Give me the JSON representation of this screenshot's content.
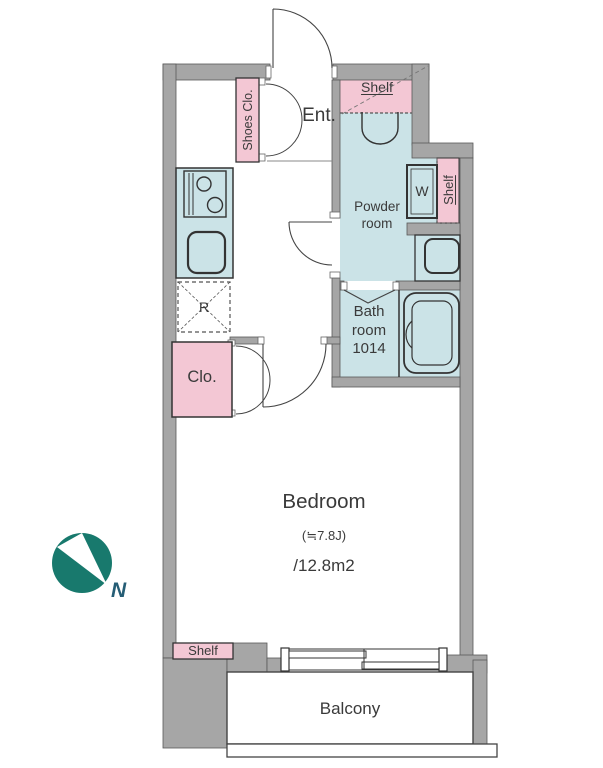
{
  "plan": {
    "entrance": {
      "label": "Ent."
    },
    "shoes_closet": {
      "label": "Shoes Clo."
    },
    "shelf_top": {
      "label": "Shelf"
    },
    "shelf_side": {
      "label": "Shelf"
    },
    "shelf_bottom": {
      "label": "Shelf"
    },
    "powder_room": {
      "label_line1": "Powder",
      "label_line2": "room"
    },
    "washer": {
      "label": "W"
    },
    "bathroom": {
      "label_line1": "Bath",
      "label_line2": "room",
      "label_line3": "1014"
    },
    "refrigerator": {
      "label": "R"
    },
    "closet": {
      "label": "Clo."
    },
    "bedroom": {
      "label": "Bedroom",
      "size_jo": "(≒7.8J)",
      "size_m2": "/12.8m2"
    },
    "balcony": {
      "label": "Balcony"
    },
    "compass": {
      "label": "N"
    }
  },
  "colors": {
    "wall_gray": "#a6a6a6",
    "wet_area_blue": "#cbe3e7",
    "storage_pink": "#f3c7d4",
    "outline": "#3f3f3f",
    "compass_teal": "#18796d",
    "north_text": "#255d75",
    "text": "#3a3a3a"
  }
}
